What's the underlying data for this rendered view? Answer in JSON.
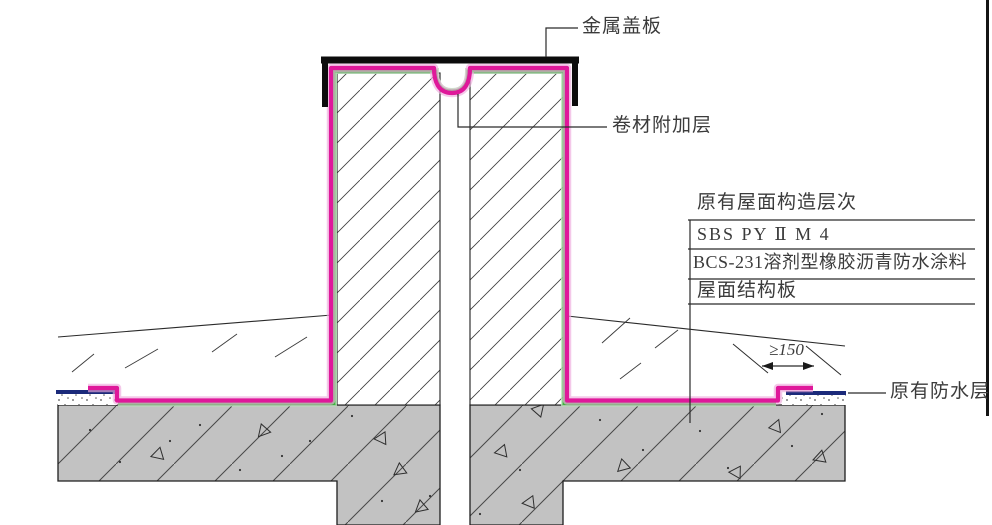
{
  "labels": {
    "metal_cover": "金属盖板",
    "membrane_layer": "卷材附加层",
    "dimension": "≥150",
    "existing_waterproof": "原有防水层"
  },
  "table": {
    "header": "原有屋面构造层次",
    "rows": [
      "SBS PY Ⅱ M 4",
      "BCS-231溶剂型橡胶沥青防水涂料",
      "屋面结构板"
    ]
  },
  "colors": {
    "membrane_magenta": "#df189a",
    "adhesive_green": "#3db53d",
    "existing_waterproof_navy": "#1b2a7a",
    "concrete_gray": "#c2c2c2",
    "line_black": "#1a1a1a"
  }
}
